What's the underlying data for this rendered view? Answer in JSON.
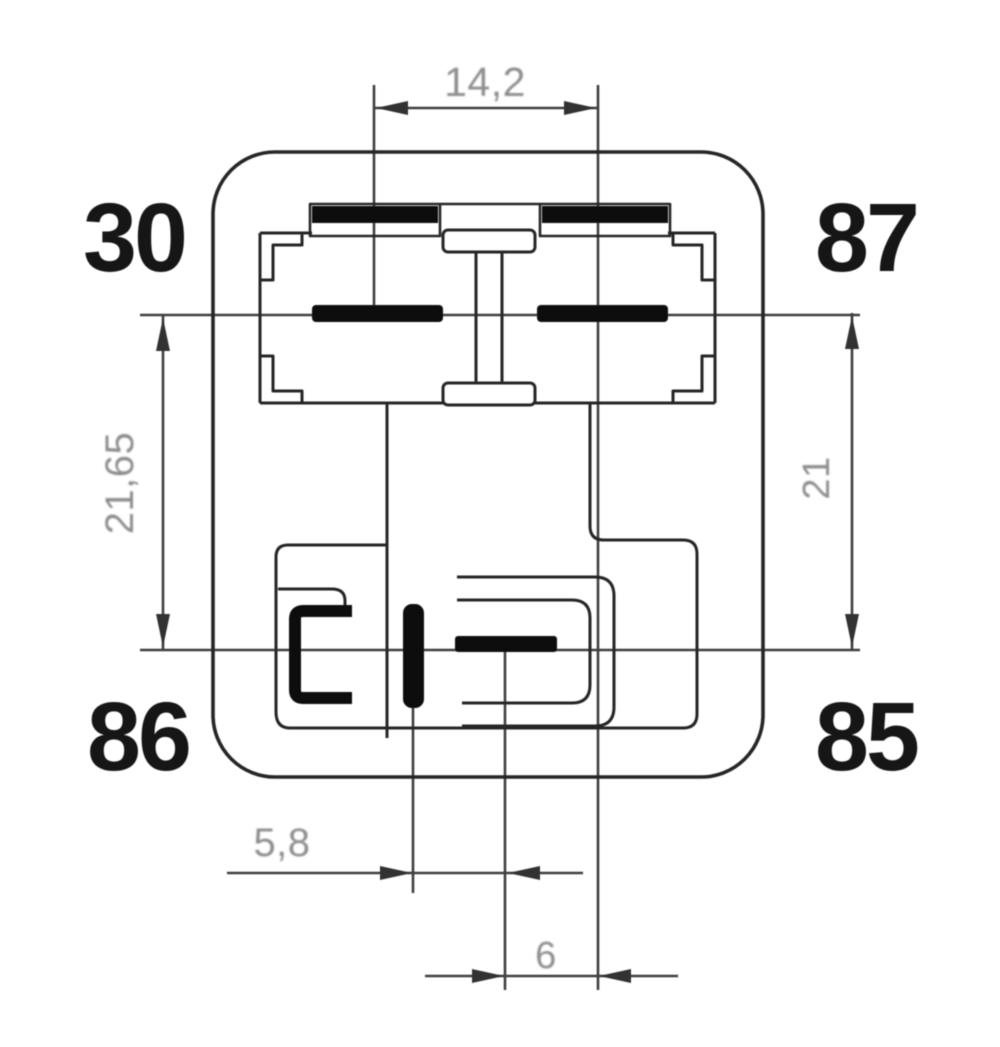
{
  "diagram": {
    "pins": {
      "top_left": "30",
      "top_right": "87",
      "bottom_left": "86",
      "bottom_right": "85"
    },
    "dims": {
      "top_width": "14,2",
      "left_height": "21,65",
      "right_height": "21",
      "bottom_left_offset": "5,8",
      "bottom_center_offset": "6"
    },
    "colors": {
      "background": "#ffffff",
      "structure_line": "#262626",
      "terminal_fill": "#0d0d0d",
      "dimension_line": "#3f3f3f",
      "dimension_text": "#8e8e8e",
      "pin_label_text": "#131313"
    }
  }
}
